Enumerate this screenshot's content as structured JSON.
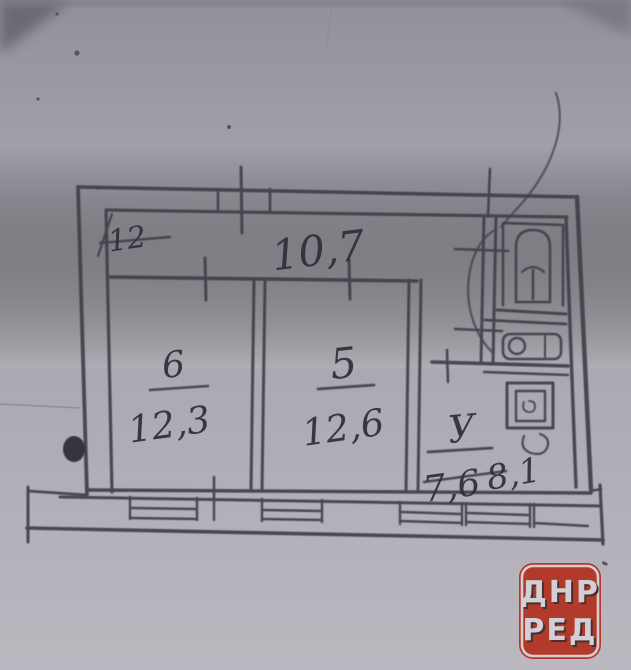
{
  "document": {
    "kind": "scanned hand-drawn apartment floor plan (BTI sketch photo)"
  },
  "plan": {
    "hall": {
      "label": "10,7"
    },
    "corner_note": {
      "label": "12"
    },
    "rooms": [
      {
        "key": "room-6",
        "number": "6",
        "area": "12,3"
      },
      {
        "key": "room-5",
        "number": "5",
        "area": "12,6"
      },
      {
        "key": "room-u",
        "number": "У",
        "area_old": "7,6",
        "area_new": "8,1"
      }
    ],
    "fixtures": [
      "toilet",
      "sink",
      "boiler-square"
    ]
  },
  "watermark": {
    "line1": "ДНР",
    "line2": "РЕД"
  },
  "colors": {
    "paper": "#a9a6af",
    "ink": "#413f49",
    "watermark_bg": "#b23a2b",
    "watermark_text": "#d2cfd7"
  }
}
